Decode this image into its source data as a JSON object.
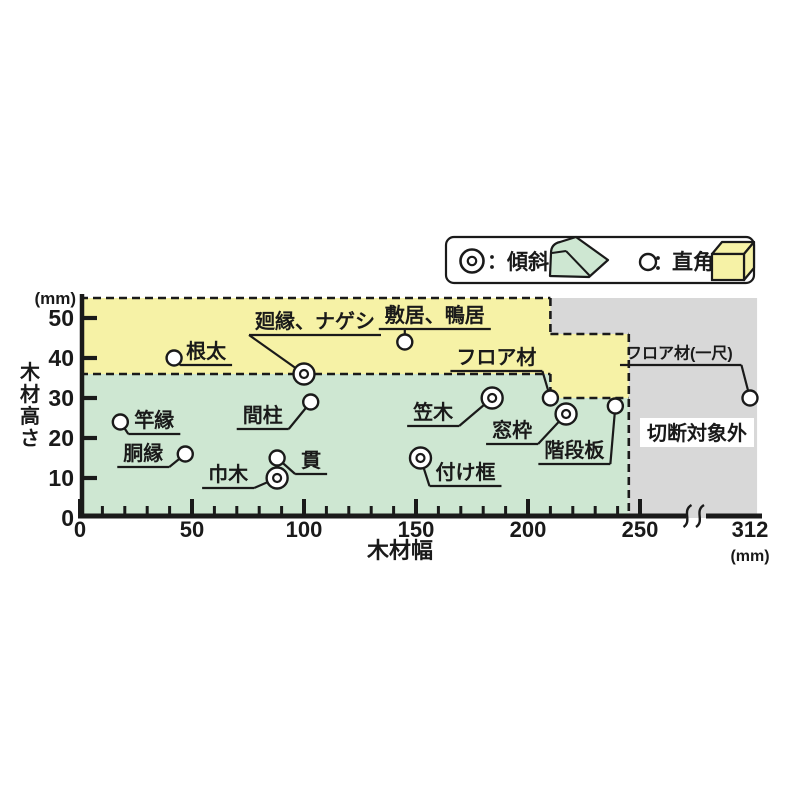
{
  "ink": "#1a1a1a",
  "legend": {
    "separator": "：",
    "items": [
      {
        "symbol": "double-circle",
        "label": "傾斜",
        "swatch_color": "#CEE7D2"
      },
      {
        "symbol": "single-circle",
        "label": "直角",
        "swatch_color": "#F6F2A6"
      }
    ]
  },
  "chart_data": {
    "type": "scatter",
    "x_label": "木材幅",
    "y_label": "木材高さ",
    "x_unit": "(mm)",
    "y_unit": "(mm)",
    "xlim": [
      0,
      312
    ],
    "ylim": [
      0,
      55
    ],
    "x_ticks": [
      0,
      50,
      100,
      150,
      200,
      250
    ],
    "x_break_tick": 312,
    "x_minor_step": 10,
    "x_minor_to": 240,
    "y_ticks": [
      0,
      10,
      20,
      30,
      40,
      50
    ],
    "excluded_label": "切断対象外",
    "regions": [
      {
        "name": "bevel",
        "legend": "傾斜",
        "color": "#CEE7D2",
        "points": [
          [
            0,
            0
          ],
          [
            0,
            36
          ],
          [
            210,
            36
          ],
          [
            210,
            30
          ],
          [
            245,
            30
          ],
          [
            245,
            0
          ]
        ]
      },
      {
        "name": "square",
        "legend": "直角",
        "color": "#F6F2A6",
        "points": [
          [
            0,
            36
          ],
          [
            0,
            55
          ],
          [
            210,
            55
          ],
          [
            210,
            46
          ],
          [
            245,
            46
          ],
          [
            245,
            30
          ],
          [
            210,
            30
          ],
          [
            210,
            36
          ]
        ]
      },
      {
        "name": "excluded",
        "legend": "切断対象外",
        "color": "#D8D8D8",
        "points": [
          [
            210,
            55
          ],
          [
            316,
            55
          ],
          [
            316,
            0
          ],
          [
            245,
            0
          ],
          [
            245,
            46
          ],
          [
            210,
            46
          ]
        ]
      }
    ],
    "boundary_dashes": [
      [
        [
          0,
          55
        ],
        [
          210,
          55
        ]
      ],
      [
        [
          0,
          36
        ],
        [
          210,
          36
        ]
      ],
      [
        [
          210,
          55
        ],
        [
          210,
          46
        ]
      ],
      [
        [
          210,
          46
        ],
        [
          245,
          46
        ]
      ],
      [
        [
          210,
          36
        ],
        [
          210,
          30
        ]
      ],
      [
        [
          210,
          30
        ],
        [
          245,
          30
        ]
      ],
      [
        [
          245,
          46
        ],
        [
          245,
          0
        ]
      ]
    ],
    "points": [
      {
        "label": "根太",
        "x": 42,
        "y": 40,
        "marker": "single",
        "layout": {
          "dx": 12,
          "dy": -17,
          "attach": "start"
        }
      },
      {
        "label": "竿縁",
        "x": 18,
        "y": 24,
        "marker": "single",
        "layout": {
          "dx": 14,
          "dy": -12,
          "attach": "start"
        }
      },
      {
        "label": "胴縁",
        "x": 47,
        "y": 16,
        "marker": "single",
        "layout": {
          "dx": -62,
          "dy": -11,
          "attach": "end"
        }
      },
      {
        "label": "廻縁、ナゲシ",
        "x": 100,
        "y": 36,
        "marker": "double",
        "layout": {
          "dx": -49,
          "dy": -63,
          "attach": "start"
        }
      },
      {
        "label": "敷居、鴨居",
        "x": 145,
        "y": 44,
        "marker": "single",
        "layout": {
          "dx": -20,
          "dy": -37,
          "attach": "under"
        }
      },
      {
        "label": "間柱",
        "x": 103,
        "y": 29,
        "marker": "single",
        "layout": {
          "dx": -68,
          "dy": 3,
          "attach": "end"
        }
      },
      {
        "label": "巾木",
        "x": 88,
        "y": 10,
        "marker": "double",
        "layout": {
          "dx": -69,
          "dy": -14,
          "attach": "end"
        }
      },
      {
        "label": "貫",
        "x": 88,
        "y": 15,
        "marker": "single",
        "layout": {
          "dx": 24,
          "dy": -8,
          "attach": "start"
        }
      },
      {
        "label": "付け框",
        "x": 152,
        "y": 15,
        "marker": "double",
        "layout": {
          "dx": 15,
          "dy": 4,
          "attach": "start"
        }
      },
      {
        "label": "笠木",
        "x": 184,
        "y": 30,
        "marker": "double",
        "layout": {
          "dx": -79,
          "dy": 4,
          "attach": "end"
        }
      },
      {
        "label": "フロア材",
        "x": 210,
        "y": 30,
        "marker": "single",
        "layout": {
          "dx": -94,
          "dy": -51,
          "attach": "end"
        }
      },
      {
        "label": "窓枠",
        "x": 217,
        "y": 26,
        "marker": "double",
        "layout": {
          "dx": -74,
          "dy": 6,
          "attach": "end"
        }
      },
      {
        "label": "階段板",
        "x": 239,
        "y": 28,
        "marker": "single",
        "layout": {
          "dx": -71,
          "dy": 34,
          "attach": "end"
        }
      },
      {
        "label": "フロア材(一尺)",
        "x": 312,
        "y": 30,
        "marker": "single",
        "layout": {
          "dx": -124,
          "dy": -53,
          "attach": "end",
          "fs": 16
        }
      }
    ]
  }
}
